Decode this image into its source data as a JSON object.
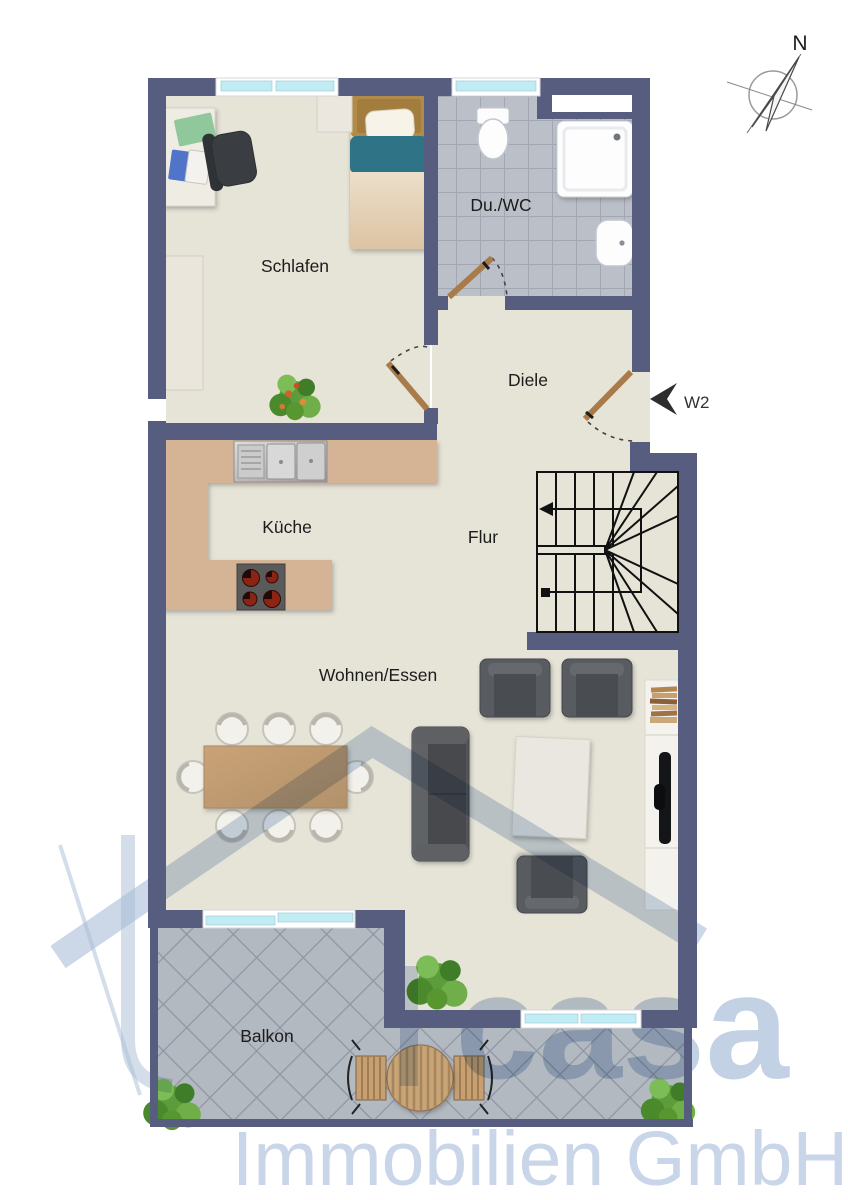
{
  "plan": {
    "compass_label": "N",
    "unit_label": "W2",
    "rooms": {
      "schlafen": {
        "label": "Schlafen"
      },
      "du_wc": {
        "label": "Du./WC"
      },
      "diele": {
        "label": "Diele"
      },
      "kueche": {
        "label": "Küche"
      },
      "flur": {
        "label": "Flur"
      },
      "wohnen_essen": {
        "label": "Wohnen/Essen"
      },
      "balkon": {
        "label": "Balkon"
      }
    }
  },
  "watermark": {
    "brand": "casa",
    "company": "Immobilien GmbH"
  },
  "colors": {
    "wall": "#565d7e",
    "floor": "#e6e3d7",
    "bath_tile": "#bbbfc7",
    "bath_grout": "#a2a7b2",
    "balcony_tile": "#b3b9c1",
    "balcony_grout": "#8e95a1",
    "kitchen_counter": "#d5b495",
    "door_wood": "#a97a4a",
    "window_glass": "#c2ecf4",
    "watermark_blue": "#b9c9e0",
    "label_text": "#1c1c1c"
  },
  "furniture": [
    "double-bed",
    "nightstand",
    "wardrobe",
    "desk",
    "office-chair",
    "houseplant",
    "toilet",
    "shower",
    "washbasin",
    "kitchen-sink",
    "cooktop",
    "dining-table",
    "dining-chairs",
    "sofa",
    "armchairs",
    "coffee-table",
    "bookshelf",
    "tv-board",
    "round-garden-table",
    "garden-chairs",
    "staircase"
  ]
}
